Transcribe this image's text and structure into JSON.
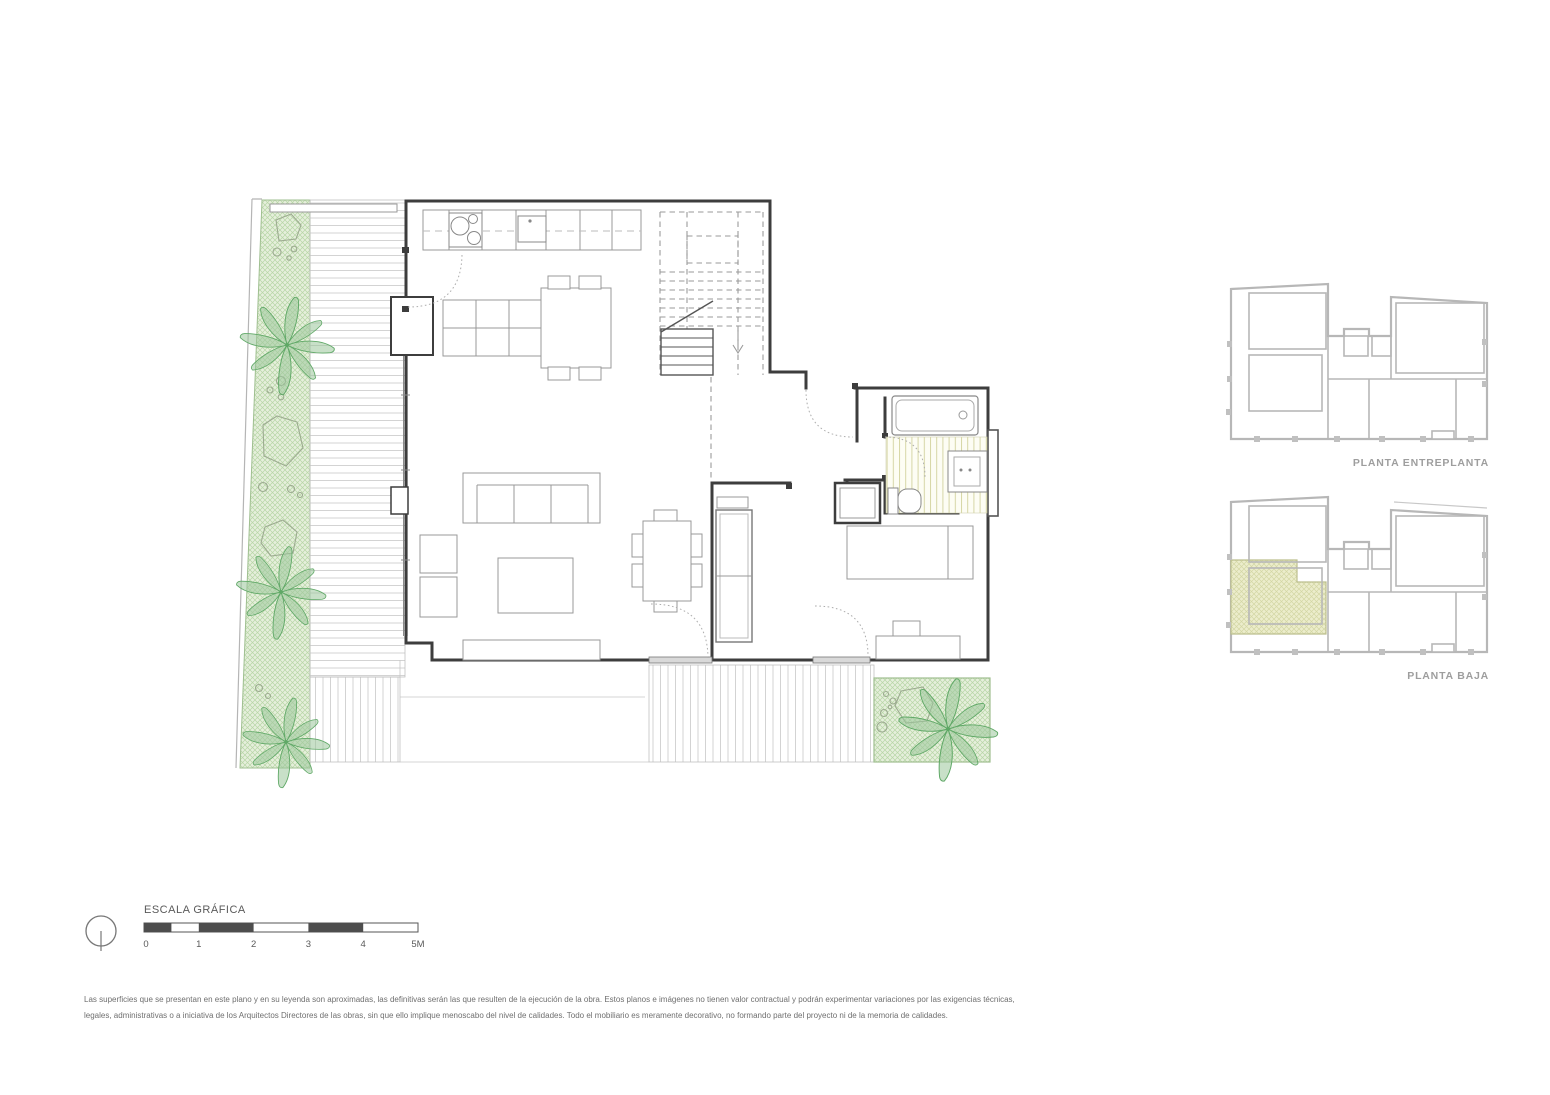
{
  "key_plans": {
    "entreplanta": {
      "label": "PLANTA ENTREPLANTA"
    },
    "baja": {
      "label": "PLANTA BAJA"
    }
  },
  "scale_bar": {
    "title": "ESCALA GRÁFICA",
    "ticks": [
      "0",
      "1",
      "2",
      "3",
      "4",
      "5M"
    ]
  },
  "disclaimer": "Las superficies que se presentan en este plano y en su leyenda son aproximadas, las definitivas serán las que resulten de la ejecución de la obra. Estos planos e imágenes no tienen valor contractual y podrán experimentar variaciones por las exigencias técnicas, legales, administrativas o a iniciativa de los Arquitectos Directores de las obras, sin que ello implique menoscabo del nivel de calidades. Todo el mobiliario es meramente decorativo, no formando parte del proyecto ni de la memoria de calidades.",
  "colors": {
    "garden_green_bg": "#e6efdc",
    "garden_green_hatch": "#b7d6a6",
    "leaf_green": "#5fa866",
    "tile_olive": "#d6d6a6",
    "highlight_khaki": "#ecedcc",
    "wall_dark": "#3d3d3d",
    "keyplan_gray": "#b7b7b7",
    "label_gray": "#9e9e9e"
  }
}
